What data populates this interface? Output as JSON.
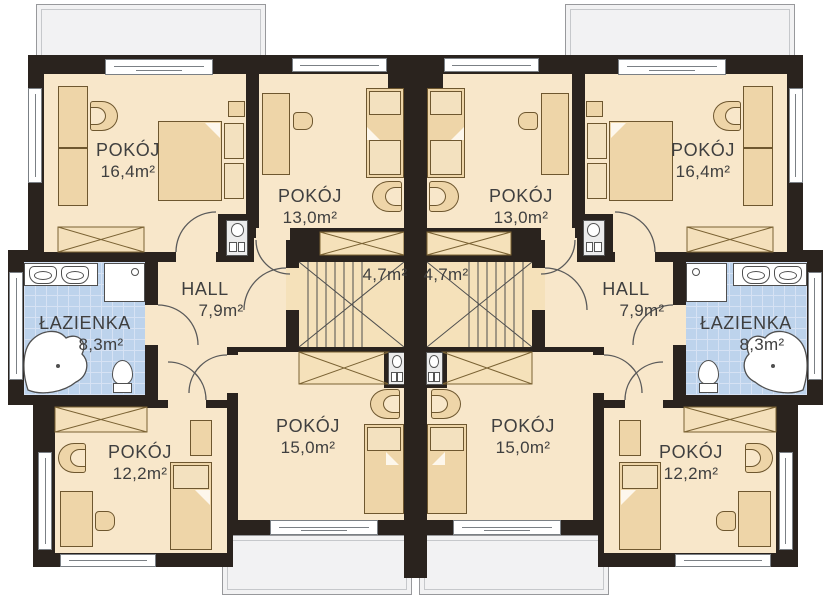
{
  "colors": {
    "wall": "#2a231e",
    "floor": "#f8e7ca",
    "floor2": "#f5e1ba",
    "bath": "#bdd3ec",
    "bathline": "#d6e2f4",
    "balc": "#f2f2f3",
    "furn": "#eed5a8",
    "furnb": "#6e572f",
    "winf": "#7b8085",
    "ink": "#4f4f4f",
    "text": "#3f3f3f"
  },
  "rooms": [
    {
      "id": "bedroom-top-left",
      "name": "POKÓJ",
      "area": "16,4m²"
    },
    {
      "id": "bedroom-mid-top-left",
      "name": "POKÓJ",
      "area": "13,0m²"
    },
    {
      "id": "hall-left",
      "name": "HALL",
      "area": "7,9m²"
    },
    {
      "id": "bathroom-left",
      "name": "ŁAZIENKA",
      "area": "8,3m²"
    },
    {
      "id": "staircase-left",
      "name": "",
      "area": "4,7m²"
    },
    {
      "id": "bedroom-mid-bottom-left",
      "name": "POKÓJ",
      "area": "15,0m²"
    },
    {
      "id": "bedroom-bottom-left",
      "name": "POKÓJ",
      "area": "12,2m²"
    },
    {
      "id": "bedroom-top-right",
      "name": "POKÓJ",
      "area": "16,4m²"
    },
    {
      "id": "bedroom-mid-top-right",
      "name": "POKÓJ",
      "area": "13,0m²"
    },
    {
      "id": "hall-right",
      "name": "HALL",
      "area": "7,9m²"
    },
    {
      "id": "bathroom-right",
      "name": "ŁAZIENKA",
      "area": "8,3m²"
    },
    {
      "id": "staircase-right",
      "name": "",
      "area": "4,7m²"
    },
    {
      "id": "bedroom-mid-bottom-right",
      "name": "POKÓJ",
      "area": "15,0m²"
    },
    {
      "id": "bedroom-bottom-right",
      "name": "POKÓJ",
      "area": "12,2m²"
    }
  ]
}
